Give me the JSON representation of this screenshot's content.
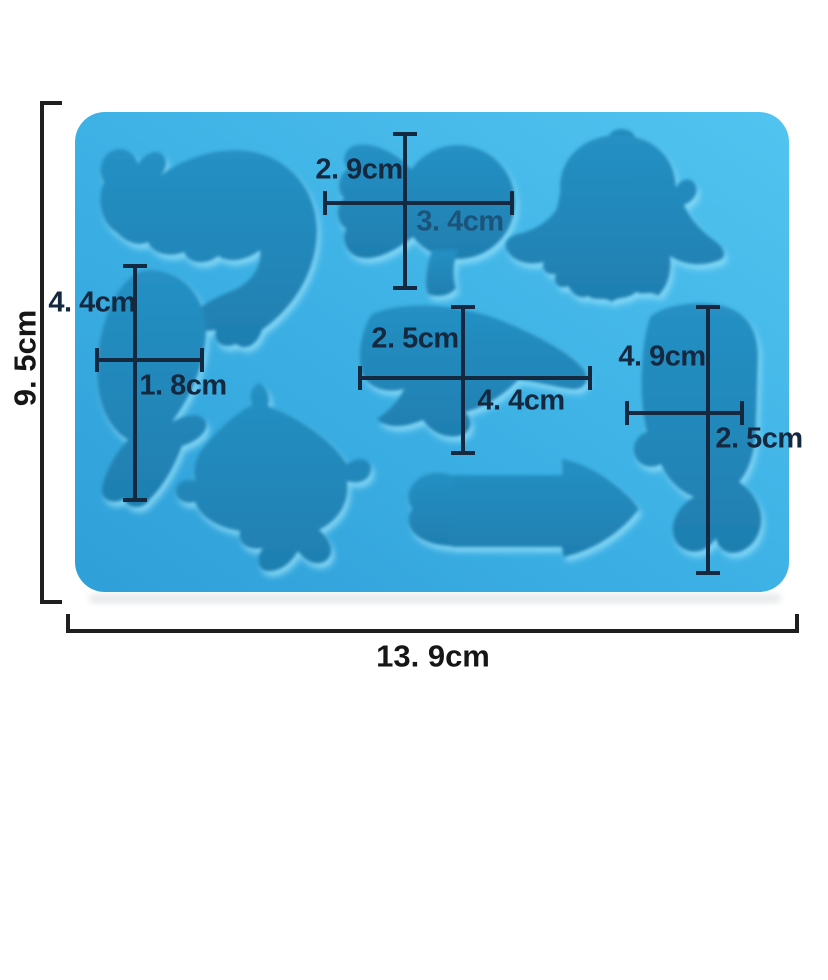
{
  "image": {
    "type": "product-photo",
    "subject": "blue silicone mold with eight sea-animal cavities and dimension annotations"
  },
  "colors": {
    "mold_light": "#52c4f0",
    "mold_mid": "#3cb0e4",
    "mold_dark": "#2f9fd8",
    "cavity_top": "#2590c4",
    "cavity_bottom": "#1f7fb0",
    "annotation_inner": "#14293f",
    "annotation_outer": "#161616",
    "background": "#ffffff"
  },
  "overall": {
    "height_label": "9. 5cm",
    "width_label": "13. 9cm"
  },
  "cavity_dimensions": [
    {
      "cavity": "fantail-fish",
      "height": "2. 9cm",
      "width": "3. 4cm"
    },
    {
      "cavity": "diving-fish",
      "height": "4. 4cm",
      "width": "1. 8cm"
    },
    {
      "cavity": "seal",
      "height": "2. 5cm",
      "width": "4. 4cm"
    },
    {
      "cavity": "whale",
      "height": "4. 9cm",
      "width": "2. 5cm"
    }
  ],
  "cavities": [
    "dolphin-crescent",
    "fantail-fish",
    "shark-front",
    "diving-fish",
    "seal",
    "dolphin-large",
    "squid-arrow",
    "whale"
  ]
}
